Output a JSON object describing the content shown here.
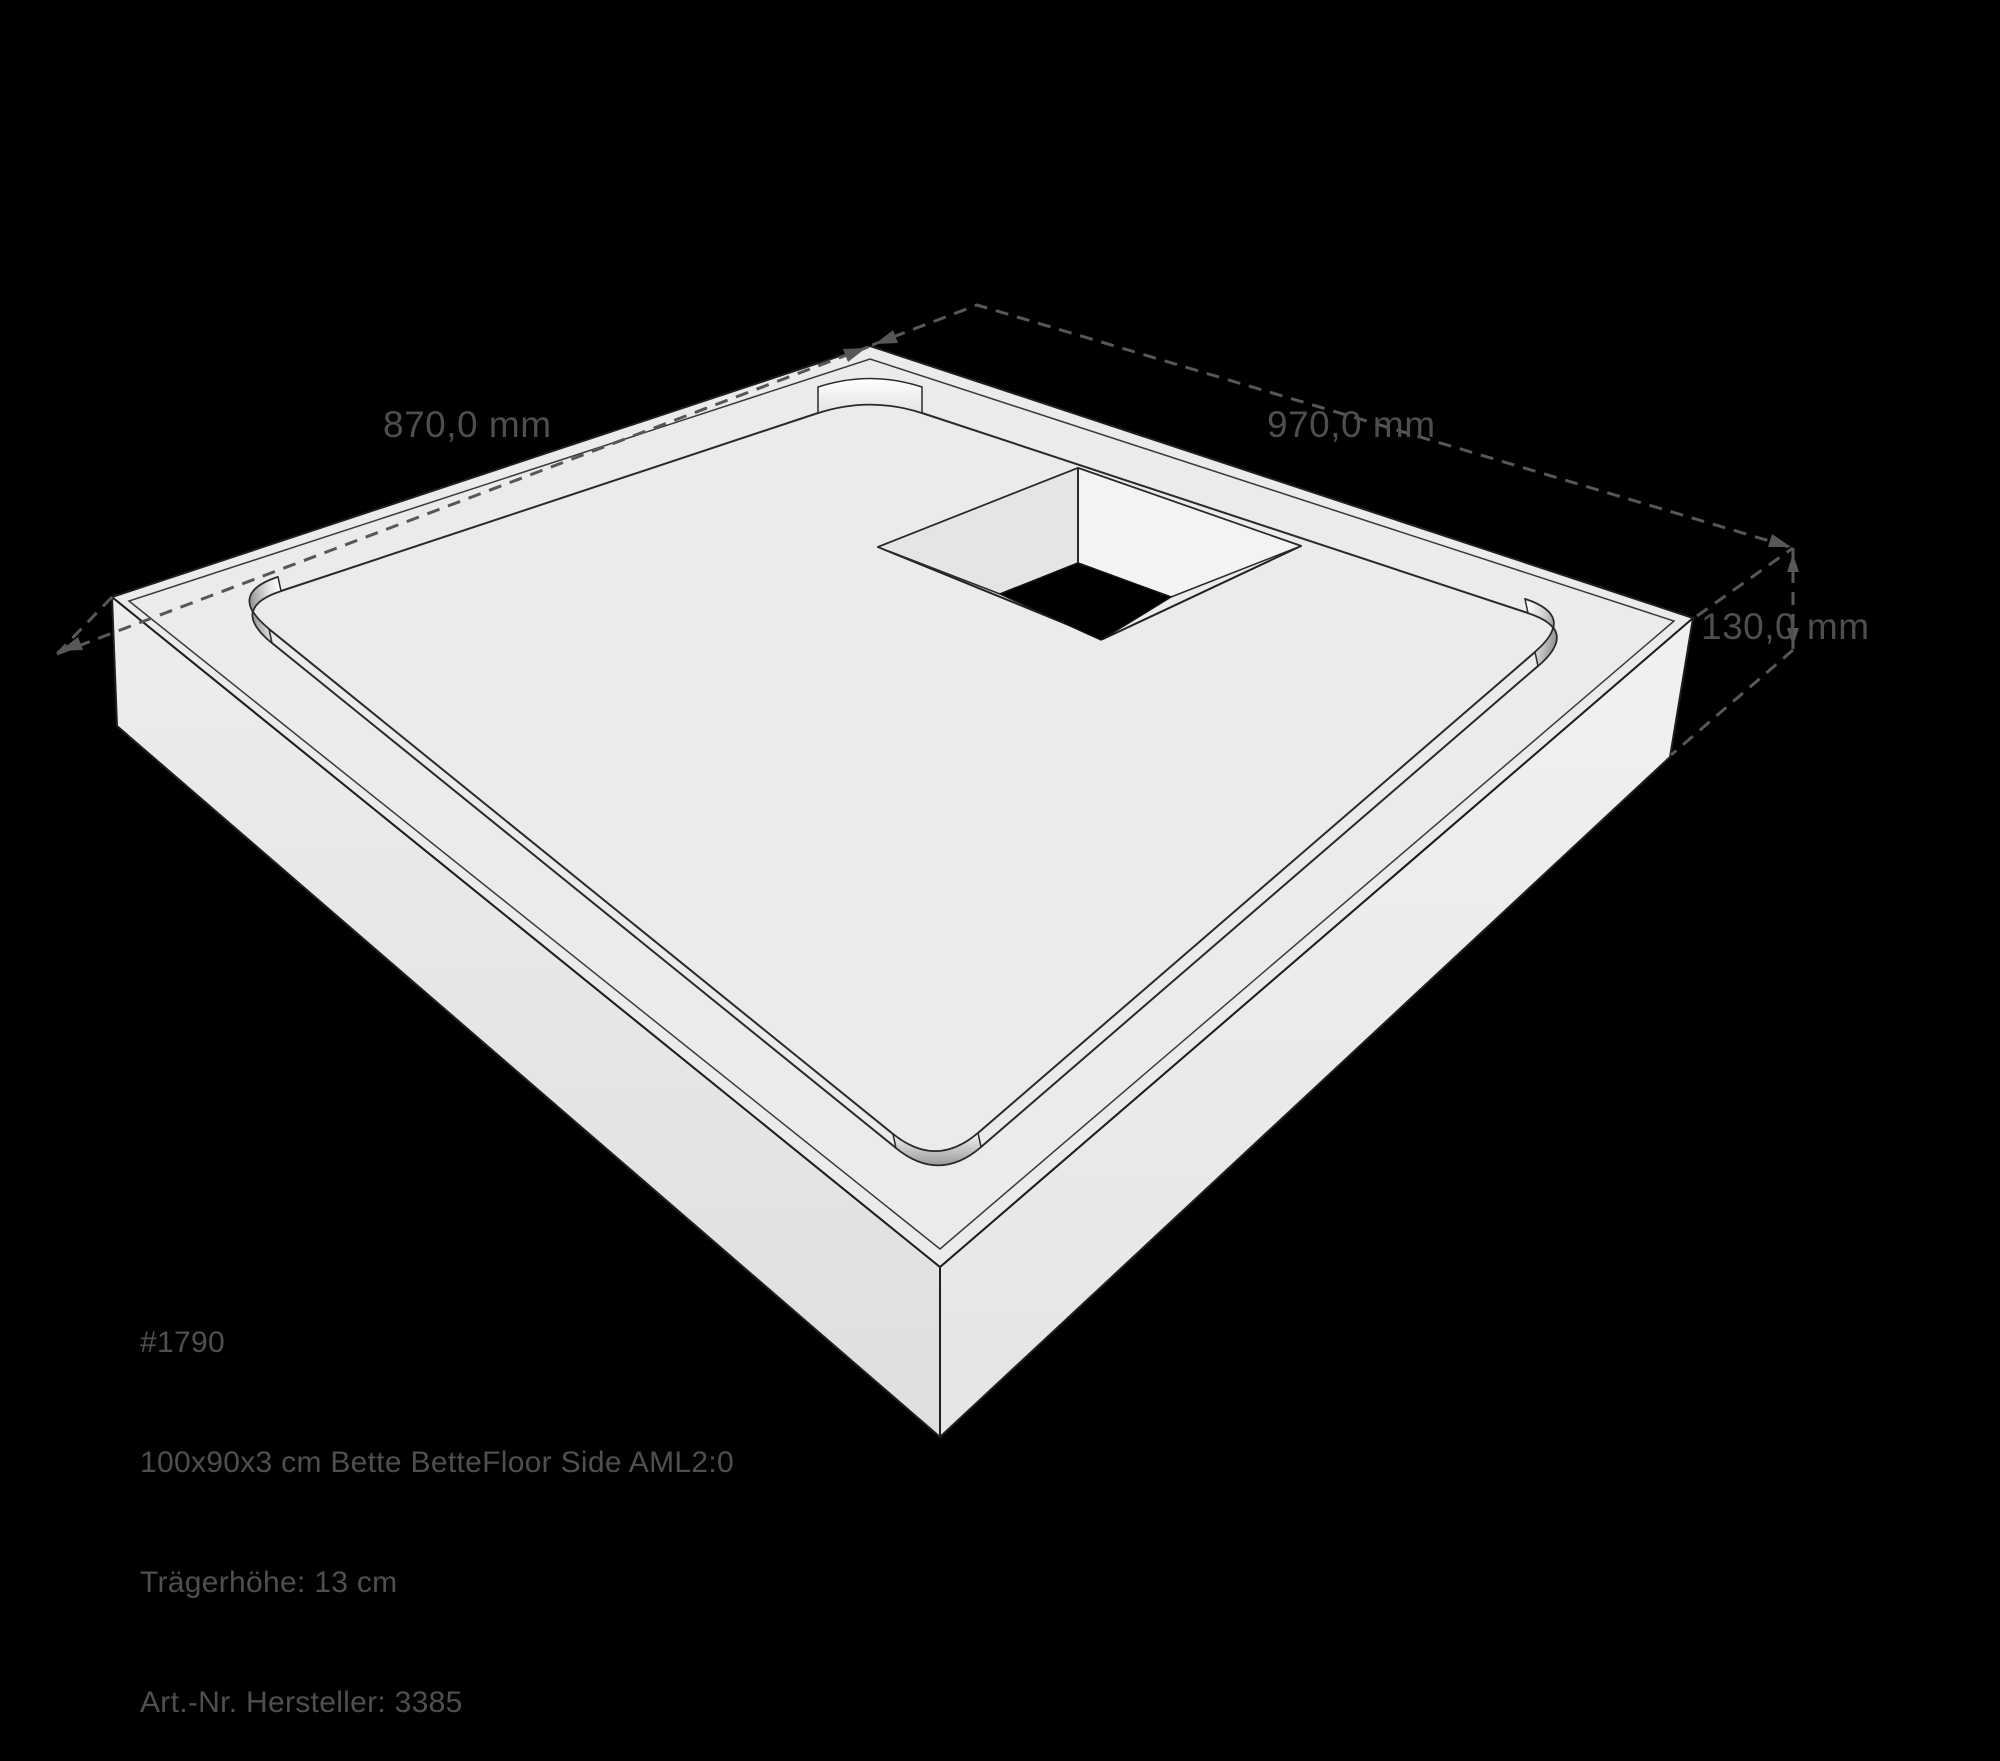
{
  "colors": {
    "background": "#000000",
    "outline": "#1f1f1f",
    "tray_rim": "#ebebeb",
    "tray_floor": "#d7d7d7",
    "side_left_top": "#ededed",
    "side_left_bottom": "#dfdfdf",
    "side_right_top": "#f1f1f1",
    "side_right_bottom": "#e5e5e5",
    "pocket_rim": "#ececec",
    "pocket_wall_left": "#e5e5e5",
    "pocket_wall_right": "#f3f3f3",
    "drain_hole": "#000000",
    "dimension_lines": "#575757",
    "dimension_text": "#4e4e4e",
    "caption_text": "#4f4f4f"
  },
  "dimensions": {
    "back_left": "870,0 mm",
    "back_right": "970,0 mm",
    "height": "130,0 mm"
  },
  "caption": {
    "model_number": "#1790",
    "product": "100x90x3 cm Bette BetteFloor Side AML2:0",
    "carrier_height": "Trägerhöhe: 13 cm",
    "article_number": "Art.-Nr. Hersteller: 3385"
  }
}
